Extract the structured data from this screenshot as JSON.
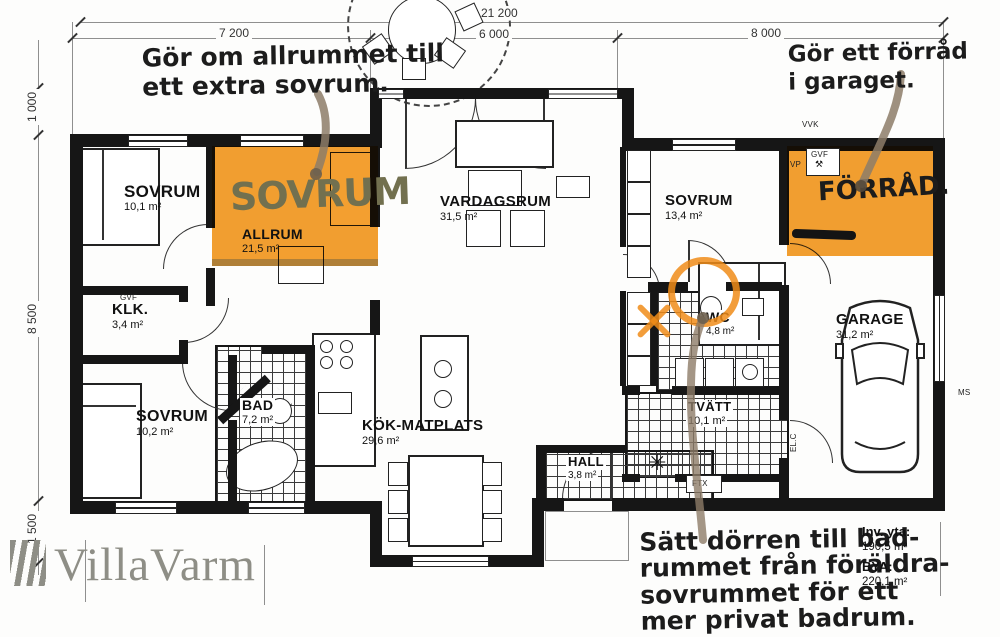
{
  "dimensions": {
    "total": "21 200",
    "seg_left": "7 200",
    "seg_mid": "6 000",
    "seg_right": "8 000",
    "v_top": "1 000",
    "v_mid": "8 500",
    "v_bottom": "1 500"
  },
  "rooms": {
    "sovrum1": {
      "name": "SOVRUM",
      "area": "10,1 m²"
    },
    "allrum": {
      "name": "ALLRUM",
      "area": "21,5 m²"
    },
    "vardagsrum": {
      "name": "VARDAGSRUM",
      "area": "31,5 m²"
    },
    "sovrum2": {
      "name": "SOVRUM",
      "area": "13,4 m²"
    },
    "klk": {
      "name": "KLK.",
      "area": "3,4 m²"
    },
    "sovrum3": {
      "name": "SOVRUM",
      "area": "10,2 m²"
    },
    "bad": {
      "name": "BAD",
      "area": "7,2 m²"
    },
    "kok": {
      "name": "KÖK-MATPLATS",
      "area": "29,6 m²"
    },
    "wc": {
      "name": "WC",
      "area": "4,8 m²"
    },
    "garage": {
      "name": "GARAGE",
      "area": "31,2 m²"
    },
    "tvatt": {
      "name": "TVÄTT",
      "area": "10,1 m²"
    },
    "hall": {
      "name": "HALL",
      "area": "3,8 m²"
    }
  },
  "annotations": {
    "make_bedroom": {
      "line1": "Gör om allrummet till",
      "line2": "ett extra sovrum."
    },
    "make_storage": {
      "line1": "Gör ett förråd",
      "line2": "i garaget."
    },
    "move_door": {
      "line1": "Sätt dörren till bad-",
      "line2": "rummet från föräldra-",
      "line3": "sovrummet för ett",
      "line4": "mer privat badrum."
    },
    "bedroom_overlay": "SOVRUM",
    "storage_overlay": "FÖRRÅD."
  },
  "totals": {
    "inv_label": "Inv. yta:",
    "inv_value": "190,5 m²",
    "bya_label": "BYA:",
    "bya_value": "220,1 m²"
  },
  "tech": {
    "vvk": "VVK",
    "gvf_klk": "GVF",
    "gvf_forrad": "GVF",
    "vp": "VP",
    "elc": "EL.C",
    "ftx": "FTX",
    "ms": "MS"
  },
  "icons": {
    "vent_star": "✳"
  },
  "watermark": "VillaVarm",
  "colors": {
    "highlight": "#f2971e",
    "wall": "#161616",
    "arrow": "#8d7c68",
    "overlay_ink": "#72704f"
  }
}
